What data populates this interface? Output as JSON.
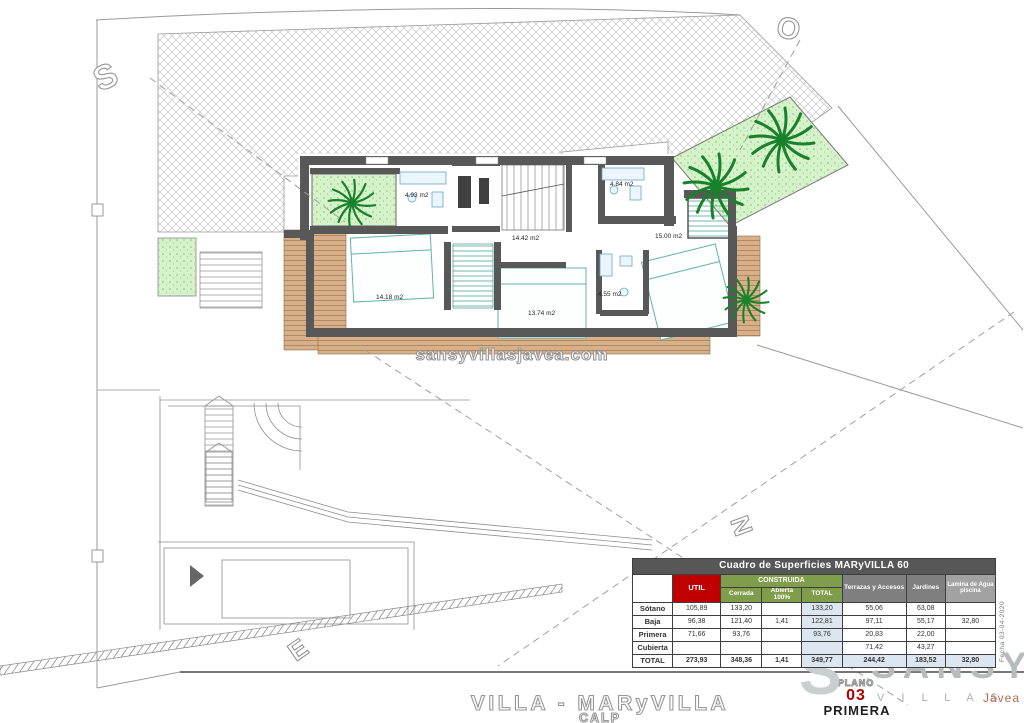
{
  "compass": {
    "s": "S",
    "o": "O",
    "e": "E",
    "n": "N"
  },
  "watermark": "sansyvillasjavea.com",
  "rooms": {
    "bath_left": "4.93 m2",
    "bath_top_right": "4.84 m2",
    "landing": "14.42 m2",
    "bedroom_right": "15.00 m2",
    "bedroom_left": "14.18 m2",
    "bedroom_mid": "13.74 m2",
    "bath_mid": "4.55 m2"
  },
  "table": {
    "title": "Cuadro de Superficies MARyVILLA 60",
    "group_header": "CONSTRUIDA",
    "col_util": "UTIL",
    "col_cerrada": "Cerrada",
    "col_abierta": "Abierta 100%",
    "col_total": "TOTAL",
    "col_terrazas": "Terrazas y Accesos",
    "col_jardines": "Jardines",
    "col_lamina": "Lamina de Agua piscina",
    "rows": [
      {
        "label": "Sótano",
        "util": "105,89",
        "cerrada": "133,20",
        "abierta": "",
        "total": "133,20",
        "terrazas": "55,06",
        "jardines": "63,08",
        "lamina": ""
      },
      {
        "label": "Baja",
        "util": "96,38",
        "cerrada": "121,40",
        "abierta": "1,41",
        "total": "122,81",
        "terrazas": "97,11",
        "jardines": "55,17",
        "lamina": "32,80"
      },
      {
        "label": "Primera",
        "util": "71,66",
        "cerrada": "93,76",
        "abierta": "",
        "total": "93,76",
        "terrazas": "20,83",
        "jardines": "22,00",
        "lamina": ""
      },
      {
        "label": "Cubierta",
        "util": "",
        "cerrada": "",
        "abierta": "",
        "total": "",
        "terrazas": "71,42",
        "jardines": "43,27",
        "lamina": ""
      },
      {
        "label": "TOTAL",
        "util": "273,93",
        "cerrada": "348,36",
        "abierta": "1,41",
        "total": "349,77",
        "terrazas": "244,42",
        "jardines": "183,52",
        "lamina": "32,80"
      }
    ]
  },
  "date_note": "Fecha  03-04-2020",
  "titleblock": {
    "title": "VILLA - MARyVILLA",
    "subtitle": "CALP",
    "plano_label": "PLANO",
    "plano_number": "03",
    "plano_name": "PRIMERA"
  },
  "logo": {
    "big_letter": "S",
    "name": "SANSY",
    "sub": "V I L L A S",
    "city": "Jávea"
  },
  "colors": {
    "util_red": "#c00000",
    "construida_green": "#7f9d4b",
    "total_blue": "#dce6f1",
    "palm_green": "#19812c",
    "plano_red": "#b30000"
  }
}
